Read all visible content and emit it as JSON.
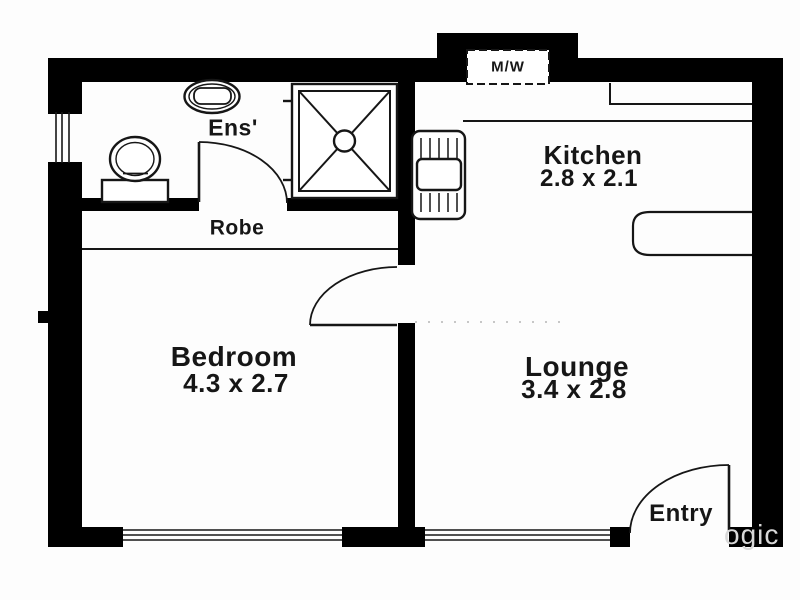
{
  "plan": {
    "type": "apartment-floor-plan",
    "colors": {
      "wall": "#000000",
      "line": "#161616",
      "text": "#161616",
      "background": "#fdfdfd",
      "watermark": "#d8d8d8"
    },
    "rooms": {
      "ensuite": {
        "label": "Ens'"
      },
      "robe": {
        "label": "Robe"
      },
      "kitchen": {
        "label": "Kitchen",
        "size": "2.8 x 2.1"
      },
      "bedroom": {
        "label": "Bedroom",
        "size": "4.3 x 2.7"
      },
      "lounge": {
        "label": "Lounge",
        "size": "3.4 x 2.8"
      },
      "entry": {
        "label": "Entry"
      }
    },
    "appliances": {
      "microwave": {
        "label": "M/W"
      }
    },
    "fixtures": [
      "toilet-icon",
      "basin-icon",
      "shower-icon",
      "kitchen-sink-icon",
      "kitchen-counter",
      "kitchen-bench-seat",
      "ensuite-door",
      "bedroom-door",
      "entry-door",
      "window-left",
      "window-bedroom",
      "window-lounge"
    ],
    "watermark": {
      "text": "ogic"
    }
  }
}
